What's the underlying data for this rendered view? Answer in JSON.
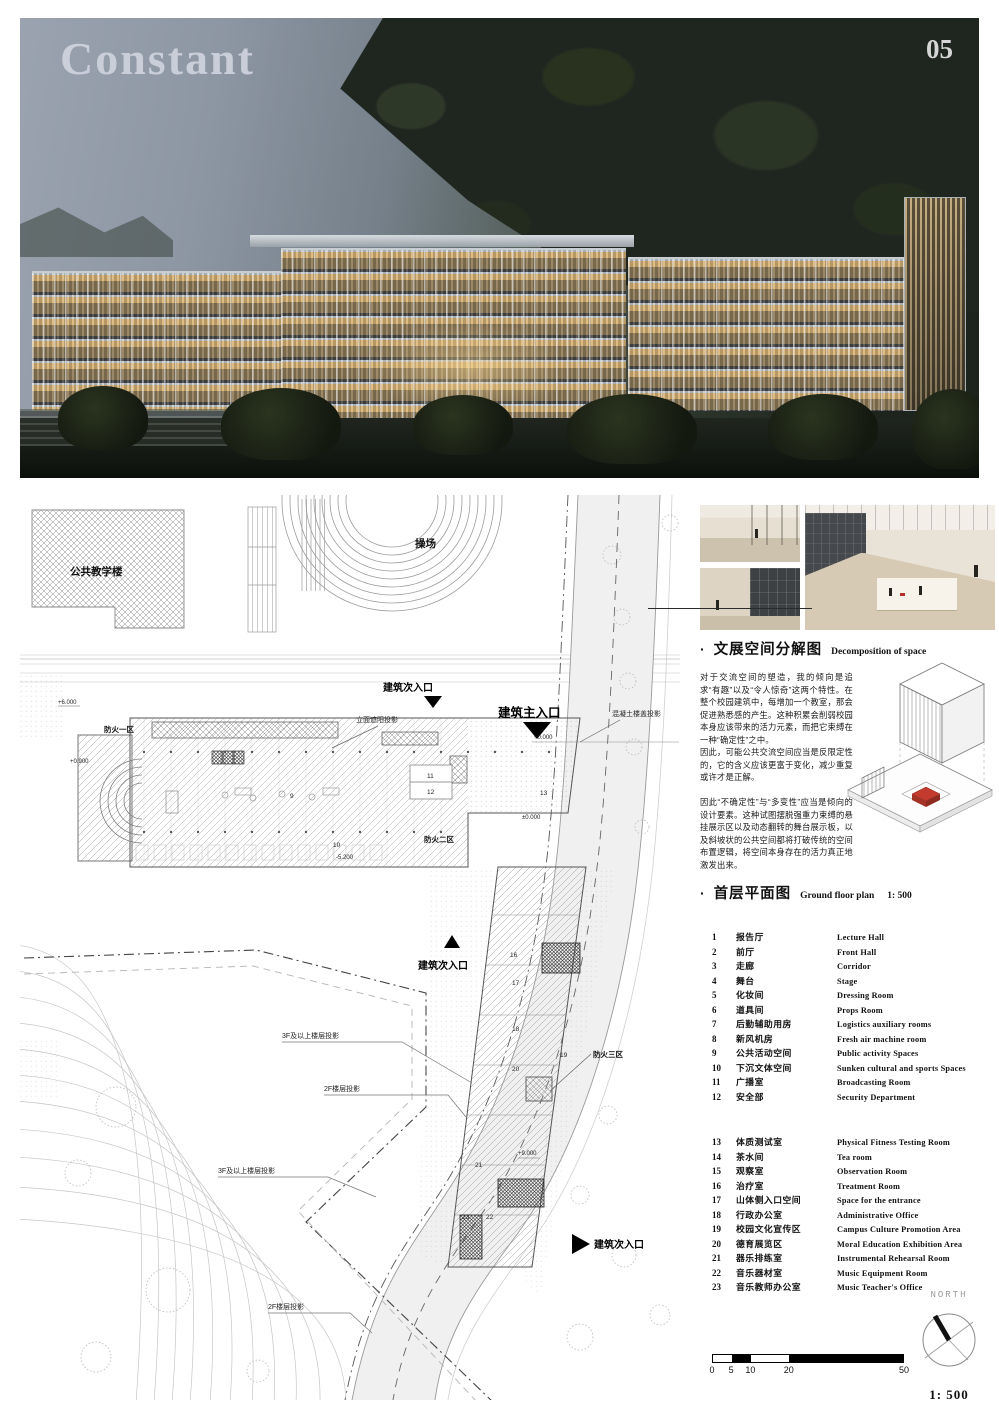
{
  "page": {
    "title": "Constant",
    "number": "05"
  },
  "plan": {
    "public_teaching_building": "公共教学楼",
    "playground": "操场",
    "entrance_secondary": "建筑次入口",
    "entrance_main": "建筑主入口",
    "fire_zone_1": "防火一区",
    "fire_zone_2": "防火二区",
    "fire_zone_3": "防火三区",
    "facade_shading_projection": "立面遮阳投影",
    "concrete_slab_projection": "混凝土楼盖投影",
    "floor_3f_projection": "3F及以上楼层投影",
    "floor_2f_projection": "2F楼层投影",
    "levels": {
      "l1": "+6.000",
      "l2": "+0.900",
      "l3": "-5.200",
      "l4": "+0.000",
      "l5": "±0.000",
      "l6": "+9.000"
    },
    "room_numbers": [
      "9",
      "10",
      "11",
      "12",
      "13",
      "16",
      "17",
      "18",
      "19",
      "20",
      "21",
      "22",
      "23"
    ]
  },
  "sections": {
    "decomposition": {
      "bullet": "·",
      "zh": "文展空间分解图",
      "en": "Decomposition of space"
    },
    "ground_floor": {
      "bullet": "·",
      "zh": "首层平面图",
      "en": "Ground floor plan",
      "scale": "1:  500"
    }
  },
  "paragraphs": {
    "p1": "对于交流空间的塑造，我的倾向是追求“有趣”以及“令人惊奇”这两个特性。在整个校园建筑中，每增加一个教室，那会促进熟悉感的产生。这种积累会削弱校园本身应该带来的活力元素，而把它束缚在一种“确定性”之中。",
    "p2": "因此，可能公共交流空间应当是反限定性的，它的含义应该更富于变化，减少重复或许才是正解。",
    "p3": "因此“不确定性”与“多变性”应当是倾向的设计要素。这种试图摆脱强重力束缚的悬挂展示区以及动态翻转的舞台展示板，以及斜坡状的公共空间都将打破传统的空间布置逻辑，将空间本身存在的活力真正地激发出来。"
  },
  "legend": {
    "items": [
      {
        "num": "1",
        "zh": "报告厅",
        "en": "Lecture Hall"
      },
      {
        "num": "2",
        "zh": "前厅",
        "en": "Front Hall"
      },
      {
        "num": "3",
        "zh": "走廊",
        "en": "Corridor"
      },
      {
        "num": "4",
        "zh": "舞台",
        "en": "Stage"
      },
      {
        "num": "5",
        "zh": "化妆间",
        "en": "Dressing Room"
      },
      {
        "num": "6",
        "zh": "道具间",
        "en": "Props Room"
      },
      {
        "num": "7",
        "zh": "后勤辅助用房",
        "en": "Logistics auxiliary rooms"
      },
      {
        "num": "8",
        "zh": "新风机房",
        "en": "Fresh air machine room"
      },
      {
        "num": "9",
        "zh": "公共活动空间",
        "en": "Public activity Spaces"
      },
      {
        "num": "10",
        "zh": "下沉文体空间",
        "en": "Sunken cultural and sports Spaces"
      },
      {
        "num": "11",
        "zh": "广播室",
        "en": "Broadcasting Room"
      },
      {
        "num": "12",
        "zh": "安全部",
        "en": "Security Department"
      },
      {
        "num": "13",
        "zh": "体质测试室",
        "en": "Physical Fitness Testing Room"
      },
      {
        "num": "14",
        "zh": "茶水间",
        "en": "Tea room"
      },
      {
        "num": "15",
        "zh": "观察室",
        "en": "Observation Room"
      },
      {
        "num": "16",
        "zh": "治疗室",
        "en": "Treatment Room"
      },
      {
        "num": "17",
        "zh": "山体侧入口空间",
        "en": "Space for the entrance"
      },
      {
        "num": "18",
        "zh": "行政办公室",
        "en": "Administrative Office"
      },
      {
        "num": "19",
        "zh": "校园文化宣传区",
        "en": "Campus Culture Promotion Area"
      },
      {
        "num": "20",
        "zh": "德育展览区",
        "en": "Moral Education Exhibition Area"
      },
      {
        "num": "21",
        "zh": "器乐排练室",
        "en": "Instrumental Rehearsal Room"
      },
      {
        "num": "22",
        "zh": "音乐器材室",
        "en": "Music Equipment Room"
      },
      {
        "num": "23",
        "zh": "音乐教师办公室",
        "en": "Music Teacher's Office"
      }
    ]
  },
  "compass": {
    "label": "NORTH",
    "scale": "1:  500"
  },
  "scalebar": {
    "t0": "0",
    "t1": "5",
    "t2": "10",
    "t3": "20",
    "t4": "50"
  },
  "colors": {
    "accent_red": "#c23b2e",
    "ink": "#111111",
    "sky": "#8d96a3"
  }
}
